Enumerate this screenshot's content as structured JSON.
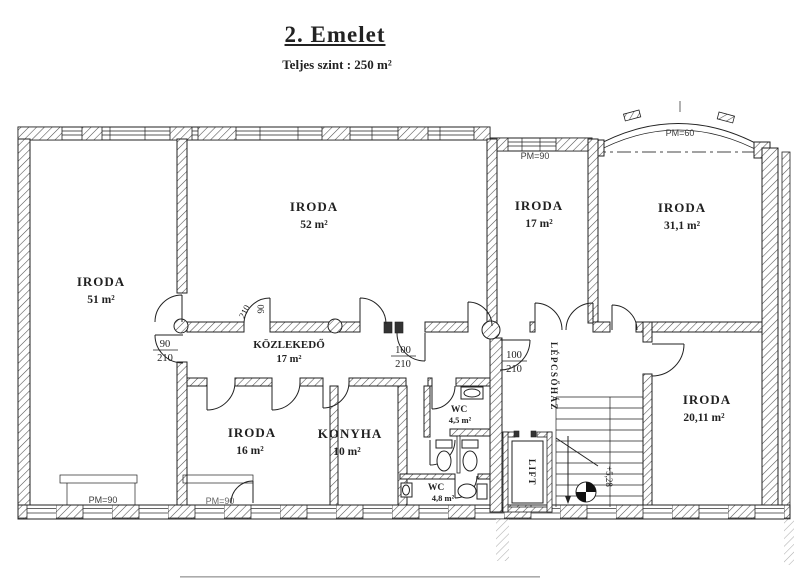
{
  "header": {
    "title": "2. Emelet",
    "subtitle": "Teljes szint : 250 m²"
  },
  "rooms": {
    "iroda51": {
      "name": "IRODA",
      "area": "51 m²"
    },
    "iroda52": {
      "name": "IRODA",
      "area": "52 m²"
    },
    "iroda17": {
      "name": "IRODA",
      "area": "17 m²"
    },
    "iroda31": {
      "name": "IRODA",
      "area": "31,1 m²"
    },
    "kozlekedo": {
      "name": "KÖZLEKEDŐ",
      "area": "17 m²"
    },
    "iroda16": {
      "name": "IRODA",
      "area": "16 m²"
    },
    "konyha": {
      "name": "KONYHA",
      "area": "10 m²"
    },
    "wc45": {
      "name": "WC",
      "area": "4,5 m²"
    },
    "wc48": {
      "name": "WC",
      "area": "4,8  m²"
    },
    "iroda20": {
      "name": "IRODA",
      "area": "20,11  m²"
    },
    "lift": {
      "name": "LIFT"
    },
    "lepcsohaz": {
      "name": "LÉPCSŐHÁZ"
    }
  },
  "door_labels": {
    "left": {
      "w": "90",
      "h": "210"
    },
    "corridor_right": {
      "w": "100",
      "h": "210"
    },
    "staircase": {
      "w": "100",
      "h": "210"
    },
    "rotated": {
      "w": "90",
      "h": "210"
    }
  },
  "parapet_labels": {
    "top": "PM=90",
    "arc": "PM=60",
    "bottom_left": "PM=90",
    "bottom_mid": "PM=90"
  },
  "level_marker": "+5,28",
  "colors": {
    "ink": "#222222",
    "paper": "#ffffff",
    "annotation": "#3c3c3c"
  }
}
